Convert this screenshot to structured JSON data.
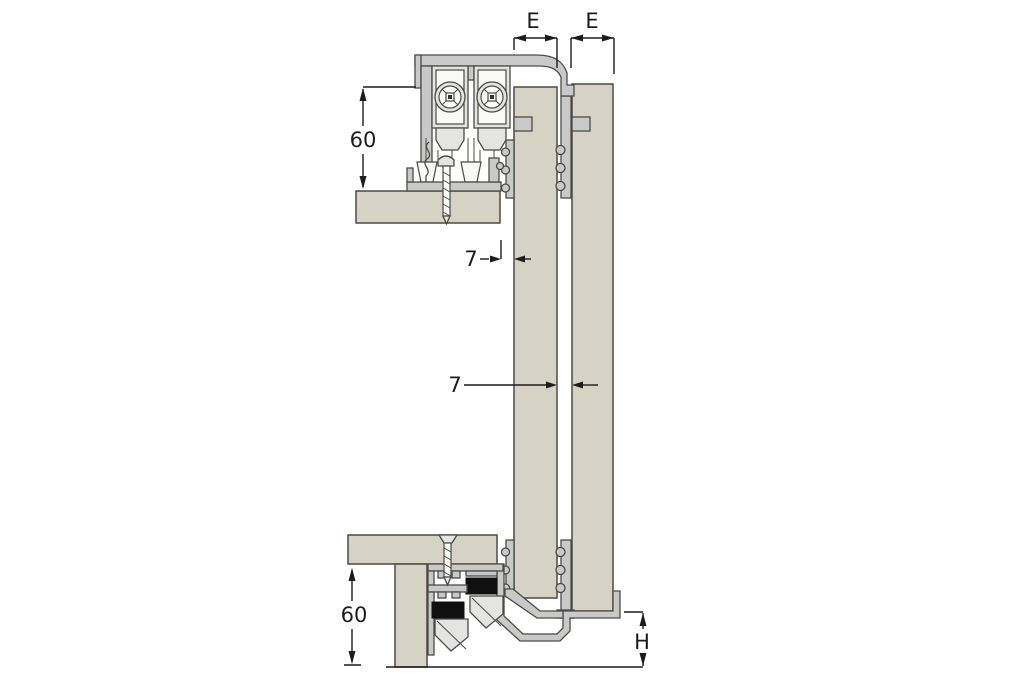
{
  "diagram": {
    "kind": "technical-cross-section",
    "subject": "sliding-door-fitting-vertical-section",
    "colors": {
      "background": "#ffffff",
      "panel_beige": "#d6d2c4",
      "profile_gray": "#c9c9c9",
      "profile_light": "#e4e4e2",
      "seal_black": "#101010",
      "outline": "#4b4b45",
      "annotation": "#1c1c1c"
    },
    "annotations": [
      {
        "id": "dim-e-left",
        "label": "E"
      },
      {
        "id": "dim-e-right",
        "label": "E"
      },
      {
        "id": "dim-60-top",
        "label": "60"
      },
      {
        "id": "dim-7-front",
        "label": "7"
      },
      {
        "id": "dim-7-gap",
        "label": "7"
      },
      {
        "id": "dim-60-bottom",
        "label": "60"
      },
      {
        "id": "dim-h",
        "label": "H"
      }
    ]
  }
}
